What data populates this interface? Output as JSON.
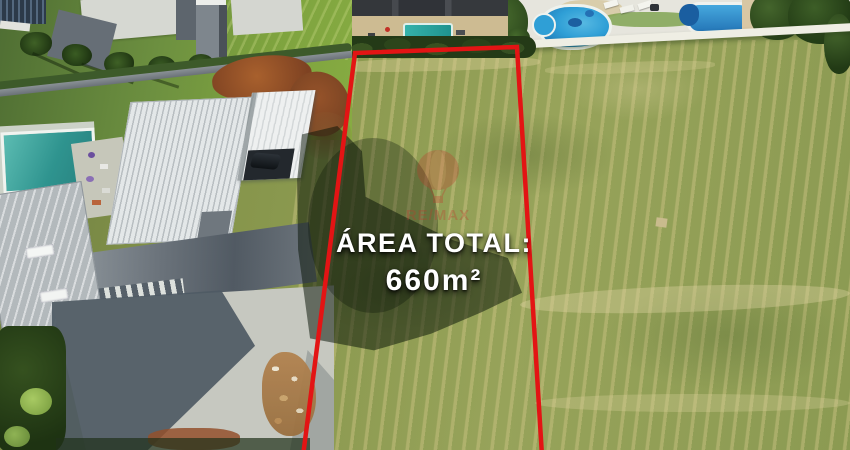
{
  "overlay": {
    "area_label": "ÁREA TOTAL:",
    "area_value": "660m²"
  },
  "watermark": {
    "brand": "RE/MAX"
  },
  "colors": {
    "boundary_outline": "#e31414",
    "overlay_text": "#ffffff",
    "watermark_red": "#c0392b",
    "grass_field": "#8b9a4e",
    "roof_white": "#e3e7e8",
    "pool_teal": "#3aa39c",
    "pool_blue": "#2f9fd6",
    "dirt_brown": "#9a5a2e",
    "concrete_gray": "#c6c8c0"
  }
}
